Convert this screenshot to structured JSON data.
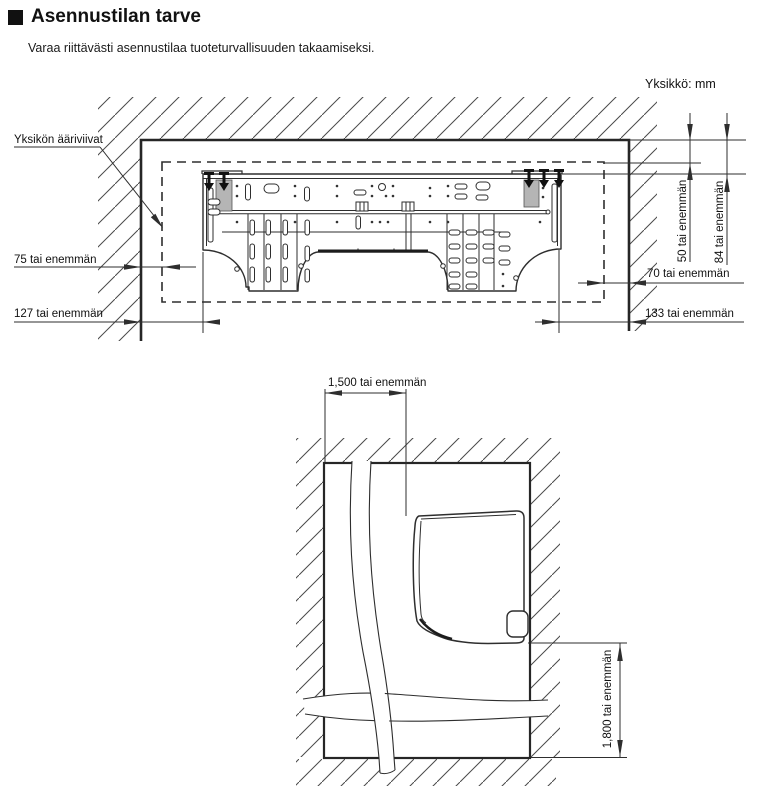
{
  "page": {
    "title": "Asennustilan tarve",
    "subtitle": "Varaa riittävästi asennustilaa tuoteturvallisuuden takaamiseksi.",
    "unit_note": "Yksikkö: mm"
  },
  "wall_diagram": {
    "outline_label": "Yksikön ääriviivat",
    "dims": {
      "left_top": "75 tai enemmän",
      "left_bottom": "127 tai enemmän",
      "top_inner": "50 tai enemmän",
      "top_outer": "84 tai enemmän",
      "right_top": "70 tai enemmän",
      "right_bottom": "133 tai enemmän"
    }
  },
  "floor_diagram": {
    "dims": {
      "front": "1,500 tai enemmän",
      "height": "1,800 tai enemmän"
    }
  },
  "colors": {
    "line": "#2e2e2e",
    "text": "#111111",
    "hatch": "#4a4a4a"
  }
}
